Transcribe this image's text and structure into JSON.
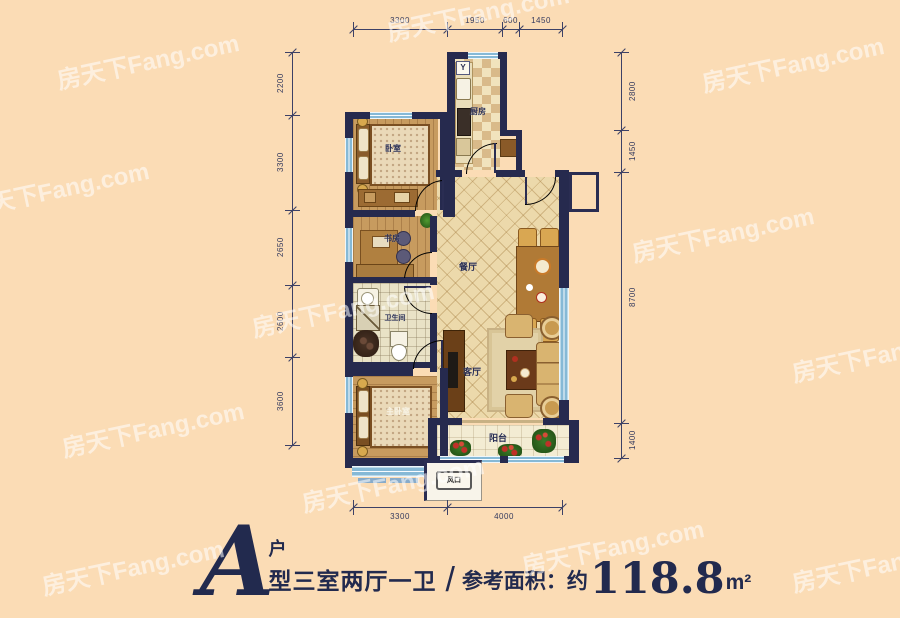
{
  "watermark": {
    "text": "房天下Fang.com"
  },
  "title": {
    "letter": "A",
    "unit_suffix": "户",
    "layout_text": "型三室两厅一卫",
    "separator": "/",
    "area_label": "参考面积：约",
    "area_value": "118.8",
    "area_unit": "m²"
  },
  "rooms": {
    "bedroom": "卧室",
    "study": "书房",
    "kitchen": "厨房",
    "bath": "卫生间",
    "dining": "餐厅",
    "living": "客厅",
    "master": "主卧室",
    "balcony": "阳台",
    "vent": "风口"
  },
  "symbols": {
    "stove": "Y"
  },
  "dimensions": {
    "top": [
      "3300",
      "1950",
      "600",
      "1450"
    ],
    "bottom": [
      "3300",
      "4000"
    ],
    "left": [
      "2200",
      "3300",
      "2650",
      "2600",
      "3600"
    ],
    "right": [
      "2800",
      "1450",
      "8700",
      "1400"
    ]
  },
  "colors": {
    "background": "#fbdcb5",
    "wall": "#262a4e",
    "window": "#86b9d6",
    "wood_floor": "#c79b5f",
    "tile_floor": "#ecd9ab",
    "title_text": "#222a4e"
  }
}
